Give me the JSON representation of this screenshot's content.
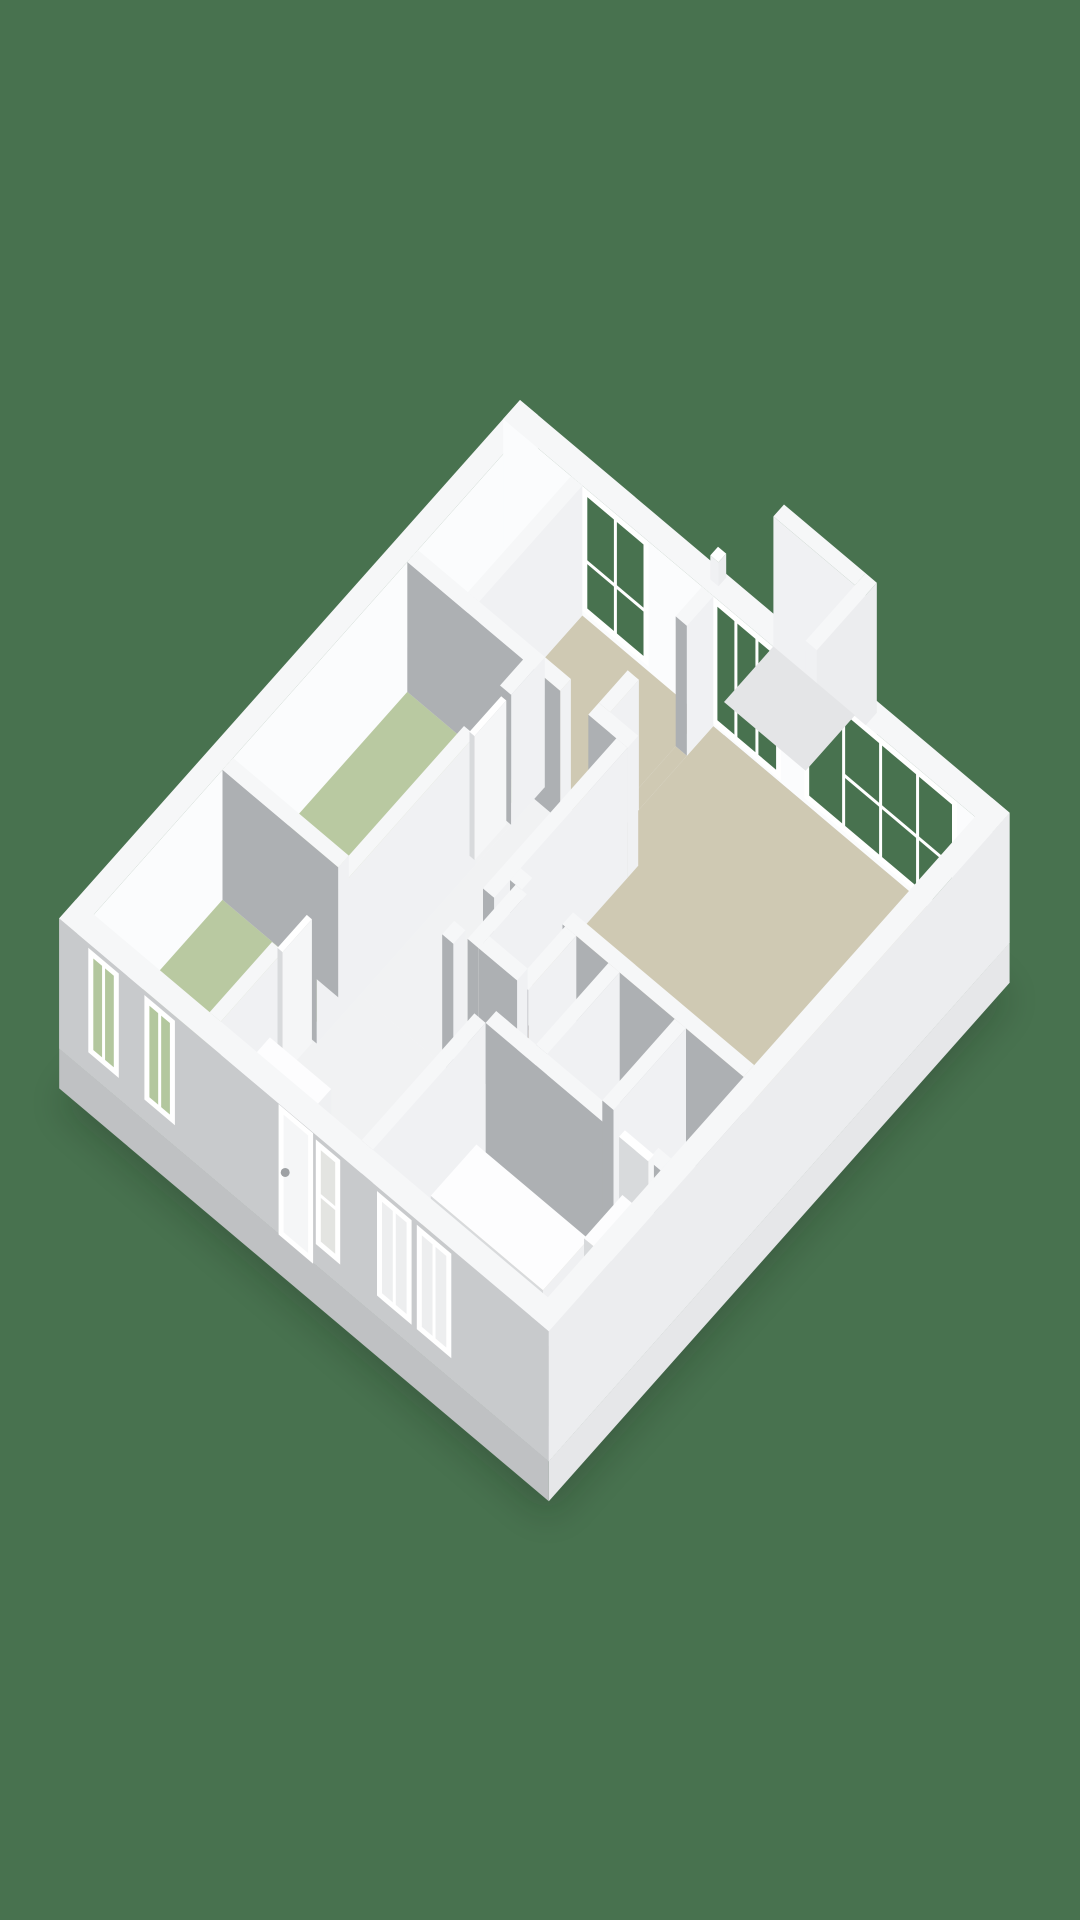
{
  "scene": {
    "description": "3d-isometric-floorplan-render",
    "canvas": {
      "width": 1080,
      "height": 1920
    },
    "background_color": "#48724F"
  },
  "projection": {
    "origin": [
      520,
      530
    ],
    "u_axis": [
      51,
      43
    ],
    "v_axis": [
      -48,
      54
    ],
    "wall_height": 130,
    "slab_depth": 40
  },
  "palette": {
    "background": "#48724F",
    "shadow": "#0A150C",
    "wall_top": "#F6F7F8",
    "wall_face_bright": "#F0F1F3",
    "wall_face_gray": "#ADB0B3",
    "facade_inner_bright": "#FBFCFD",
    "facade_outer_gray": "#C8CACC",
    "facade_outer_light": "#ECEDEF",
    "slab_face_light": "#E6E7E9",
    "slab_face_gray": "#BFC1C3",
    "floor_beige": "#CFC9B3",
    "floor_green": "#B9C9A1",
    "floor_white": "#F1F2F3",
    "floor_terrace": "#E4E5E7",
    "stair_dark": "#2B241E",
    "stair_brown_1": "#6B4B33",
    "stair_brown_2": "#433427",
    "stair_brown_3": "#755438",
    "stair_brown_4": "#372B21",
    "furniture_top": "#FDFDFE",
    "furniture_face_light": "#EFF0F2",
    "furniture_face_dark": "#D8DADC",
    "window_frame": "#FFFFFF",
    "window_frame_soft": "#F2F3F4",
    "glass_outside": "#48724F",
    "glass_green_room": "#B3C79E",
    "glass_white_room": "#E3E4E1",
    "glass_bath_room": "#EDEEEF",
    "door_leaf": "#F5F6F7",
    "door_handle": "#9EA1A4"
  },
  "building": {
    "size_units": [
      9.6,
      9.6
    ],
    "slabs": [
      {
        "name": "base-slab-main",
        "r": [
          0,
          0,
          9.6,
          9.6
        ],
        "z": [
          -40,
          0
        ]
      },
      {
        "name": "base-slab-porch",
        "r": [
          4.0,
          -1.25,
          5.82,
          0
        ],
        "z": [
          -40,
          0
        ]
      }
    ],
    "facades": [
      {
        "name": "facade-northwest",
        "r": [
          0,
          0,
          0.35,
          9.6
        ],
        "top": "wall_top",
        "fu": "facade_inner_bright",
        "fv": "facade_outer_gray"
      },
      {
        "name": "facade-northeast",
        "r": [
          0,
          0,
          9.6,
          0.35
        ],
        "top": "wall_top",
        "fu": "facade_outer_light",
        "fv": "facade_inner_bright"
      }
    ],
    "facades_near": [
      {
        "name": "facade-southwest",
        "r": [
          0,
          9.25,
          9.6,
          9.6
        ],
        "top": "wall_top",
        "fu": "facade_outer_light",
        "fv": "facade_outer_gray"
      },
      {
        "name": "facade-southeast",
        "r": [
          9.25,
          0,
          9.6,
          9.6
        ],
        "top": "wall_top",
        "fu": "facade_outer_light",
        "fv": "facade_outer_gray"
      }
    ],
    "wing_walls": [
      {
        "name": "porch-wall-far",
        "r": [
          4.0,
          -1.25,
          5.6,
          -1.03
        ],
        "top": "wall_top",
        "fu": "facade_outer_light",
        "fv": "wall_face_bright"
      },
      {
        "name": "porch-wall-side",
        "r": [
          5.6,
          -1.25,
          5.82,
          0
        ],
        "top": "wall_top",
        "fu": "facade_outer_light",
        "fv": "wall_face_bright"
      }
    ],
    "terrace": {
      "name": "terrace-floor",
      "r": [
        4.0,
        -1.03,
        5.6,
        0
      ],
      "color": "floor_terrace"
    },
    "vent": {
      "name": "roof-vent-stub",
      "r": [
        3.92,
        0.04,
        4.08,
        0.2
      ],
      "z": [
        130,
        154
      ]
    },
    "floors": [
      {
        "name": "room-study",
        "r": [
          0.35,
          0.35,
          1.33,
          2.5
        ],
        "color": "floor_white"
      },
      {
        "name": "room-top-bedroom",
        "r": [
          1.55,
          0.35,
          3.9,
          2.5
        ],
        "color": "floor_beige"
      },
      {
        "name": "room-living",
        "r": [
          4.12,
          0.35,
          9.25,
          4.95
        ],
        "color": "floor_beige"
      },
      {
        "name": "room-bedroom-1",
        "r": [
          0.35,
          2.72,
          2.62,
          6.35
        ],
        "color": "floor_green"
      },
      {
        "name": "room-bedroom-2",
        "r": [
          0.35,
          6.57,
          2.62,
          9.25
        ],
        "color": "floor_green"
      },
      {
        "name": "room-corridor",
        "r": [
          2.84,
          2.72,
          4.45,
          6.35
        ],
        "color": "floor_white"
      },
      {
        "name": "room-hall",
        "r": [
          2.84,
          6.35,
          5.82,
          9.25
        ],
        "color": "floor_white"
      },
      {
        "name": "room-center-cells",
        "r": [
          4.67,
          5.17,
          9.25,
          6.68
        ],
        "color": "floor_white"
      },
      {
        "name": "room-bathroom",
        "r": [
          5.82,
          6.9,
          9.25,
          9.25
        ],
        "color": "floor_beige"
      },
      {
        "name": "threshold-1",
        "r": [
          3.35,
          2.5,
          3.9,
          2.72
        ],
        "color": "floor_white"
      },
      {
        "name": "threshold-2",
        "r": [
          3.9,
          0.9,
          4.12,
          1.9
        ],
        "color": "floor_beige"
      },
      {
        "name": "threshold-3",
        "r": [
          2.62,
          3.2,
          2.84,
          3.95
        ],
        "color": "floor_white"
      },
      {
        "name": "threshold-4",
        "r": [
          2.62,
          7.25,
          2.84,
          7.95
        ],
        "color": "floor_white"
      },
      {
        "name": "threshold-5",
        "r": [
          4.9,
          4.95,
          5.7,
          5.17
        ],
        "color": "floor_white"
      },
      {
        "name": "threshold-6",
        "r": [
          4.45,
          5.5,
          4.67,
          6.1
        ],
        "color": "floor_white"
      },
      {
        "name": "threshold-7",
        "r": [
          8.35,
          6.68,
          9.0,
          6.9
        ],
        "color": "floor_beige"
      }
    ],
    "stairs": {
      "name": "stair-shaft",
      "r": [
        5.0,
        5.17,
        5.75,
        5.95
      ],
      "floor_color": "stair_dark",
      "step_colors": [
        "stair_brown_1",
        "stair_brown_2",
        "stair_brown_3",
        "stair_brown_4",
        "stair_brown_1"
      ],
      "step_width": 0.12,
      "step_gap": 0.03,
      "inset_v": 0.05
    },
    "interior_walls": [
      {
        "name": "wall-study-bedroom",
        "r": [
          1.33,
          0.35,
          1.55,
          2.5
        ]
      },
      {
        "name": "wall-bedroom-living-a",
        "r": [
          3.9,
          0.35,
          4.12,
          0.9
        ]
      },
      {
        "name": "wall-bedroom-living-b",
        "r": [
          3.9,
          1.9,
          4.12,
          2.5
        ]
      },
      {
        "name": "wall-top-south-a",
        "r": [
          0.35,
          2.5,
          3.35,
          2.72
        ]
      },
      {
        "name": "wall-top-south-b",
        "r": [
          3.9,
          2.5,
          4.67,
          2.72
        ]
      },
      {
        "name": "wall-green-east-a",
        "r": [
          2.62,
          2.5,
          2.84,
          3.2
        ]
      },
      {
        "name": "wall-green-east-b",
        "r": [
          2.62,
          3.95,
          2.84,
          7.25
        ]
      },
      {
        "name": "wall-green-east-c",
        "r": [
          2.62,
          7.95,
          2.84,
          9.25
        ]
      },
      {
        "name": "wall-between-bedrooms",
        "r": [
          0.35,
          6.35,
          2.62,
          6.57
        ]
      },
      {
        "name": "wall-corridor-east-a",
        "r": [
          4.45,
          2.72,
          4.67,
          5.5
        ]
      },
      {
        "name": "wall-corridor-east-b",
        "r": [
          4.45,
          6.1,
          4.67,
          6.35
        ]
      },
      {
        "name": "wall-living-south-a",
        "r": [
          4.67,
          4.95,
          4.9,
          5.17
        ]
      },
      {
        "name": "wall-living-south-b",
        "r": [
          5.7,
          4.95,
          9.25,
          5.17
        ]
      },
      {
        "name": "wall-shaft-west",
        "r": [
          4.78,
          5.17,
          5.0,
          6.17
        ]
      },
      {
        "name": "wall-shaft-east",
        "r": [
          5.75,
          5.17,
          5.97,
          6.17
        ]
      },
      {
        "name": "wall-shaft-south",
        "r": [
          5.0,
          5.95,
          5.75,
          6.17
        ]
      },
      {
        "name": "wall-cell-a",
        "r": [
          6.6,
          5.17,
          6.82,
          6.68
        ]
      },
      {
        "name": "wall-cell-b",
        "r": [
          7.9,
          5.17,
          8.12,
          6.68
        ]
      },
      {
        "name": "wall-bath-north-a",
        "r": [
          5.82,
          6.68,
          8.35,
          6.9
        ]
      },
      {
        "name": "wall-bath-north-b",
        "r": [
          9.0,
          6.68,
          9.25,
          6.9
        ]
      },
      {
        "name": "wall-bath-west",
        "r": [
          5.6,
          6.9,
          5.82,
          9.25
        ]
      }
    ],
    "door_leaves": [
      {
        "name": "door-bedroom-1",
        "r": [
          2.68,
          3.24,
          2.78,
          3.9
        ],
        "z": [
          0,
          124
        ]
      },
      {
        "name": "door-bedroom-2",
        "r": [
          2.68,
          7.29,
          2.78,
          7.9
        ],
        "z": [
          0,
          124
        ]
      },
      {
        "name": "door-bathroom",
        "r": [
          8.39,
          6.73,
          8.96,
          6.85
        ],
        "z": [
          0,
          124
        ]
      }
    ],
    "furniture": [
      {
        "name": "bathtub",
        "r": [
          6.25,
          7.55,
          8.45,
          8.5
        ],
        "z": [
          0,
          62
        ]
      },
      {
        "name": "washer-unit",
        "r": [
          8.55,
          6.95,
          9.15,
          7.75
        ],
        "z": [
          0,
          78
        ]
      },
      {
        "name": "kitchen-counter",
        "r": [
          3.05,
          8.45,
          4.25,
          9.15
        ],
        "z": [
          0,
          80
        ]
      },
      {
        "name": "kitchen-counter-low",
        "r": [
          2.58,
          8.72,
          3.05,
          9.15
        ],
        "z": [
          0,
          56
        ]
      }
    ],
    "windows_far": [
      {
        "name": "window-top-bedroom",
        "plane": "v",
        "c": 0.35,
        "a": [
          1.6,
          2.8
        ],
        "z": [
          8,
          126
        ],
        "glass": "glass_outside",
        "verticals": [
          0.5
        ],
        "horizontals": [
          [
            0.42,
            0,
            1
          ]
        ]
      },
      {
        "name": "sliding-door-terrace",
        "plane": "v",
        "c": 0.35,
        "a": [
          4.15,
          5.4
        ],
        "z": [
          6,
          126
        ],
        "glass": "glass_outside",
        "verticals": [
          0.33,
          0.66
        ],
        "horizontals": []
      },
      {
        "name": "window-living-large",
        "plane": "v",
        "c": 0.35,
        "a": [
          5.95,
          8.85
        ],
        "z": [
          8,
          126
        ],
        "glass": "glass_outside",
        "verticals": [
          0.25,
          0.5,
          0.75
        ],
        "horizontals": [
          [
            0.45,
            0.25,
            1
          ]
        ]
      }
    ],
    "openings_near": [
      {
        "name": "window-bedroom2-west",
        "plane": "v",
        "c": 9.6,
        "a": [
          0.62,
          1.12
        ],
        "z": [
          24,
          122
        ],
        "glass": "glass_green_room",
        "verticals": [
          0.5
        ],
        "horizontals": []
      },
      {
        "name": "window-bedroom2-east",
        "plane": "v",
        "c": 9.6,
        "a": [
          1.72,
          2.22
        ],
        "z": [
          24,
          122
        ],
        "glass": "glass_green_room",
        "verticals": [
          0.5
        ],
        "horizontals": []
      },
      {
        "name": "front-door",
        "plane": "v",
        "c": 9.6,
        "a": [
          4.35,
          4.93
        ],
        "z": [
          2,
          126
        ],
        "type": "door",
        "leaf": "door_leaf",
        "handle": true
      },
      {
        "name": "window-hall-sidelight",
        "plane": "v",
        "c": 9.6,
        "a": [
          5.08,
          5.46
        ],
        "z": [
          24,
          122
        ],
        "glass": "glass_white_room",
        "verticals": [],
        "horizontals": [
          [
            0.5,
            0,
            1
          ]
        ]
      },
      {
        "name": "window-bathroom-west",
        "plane": "v",
        "c": 9.6,
        "a": [
          6.28,
          6.86
        ],
        "z": [
          24,
          122
        ],
        "glass": "glass_bath_room",
        "verticals": [
          0.5
        ],
        "horizontals": []
      },
      {
        "name": "window-bathroom-east",
        "plane": "v",
        "c": 9.6,
        "a": [
          7.06,
          7.64
        ],
        "z": [
          24,
          122
        ],
        "glass": "glass_bath_room",
        "verticals": [
          0.5
        ],
        "horizontals": []
      }
    ]
  }
}
